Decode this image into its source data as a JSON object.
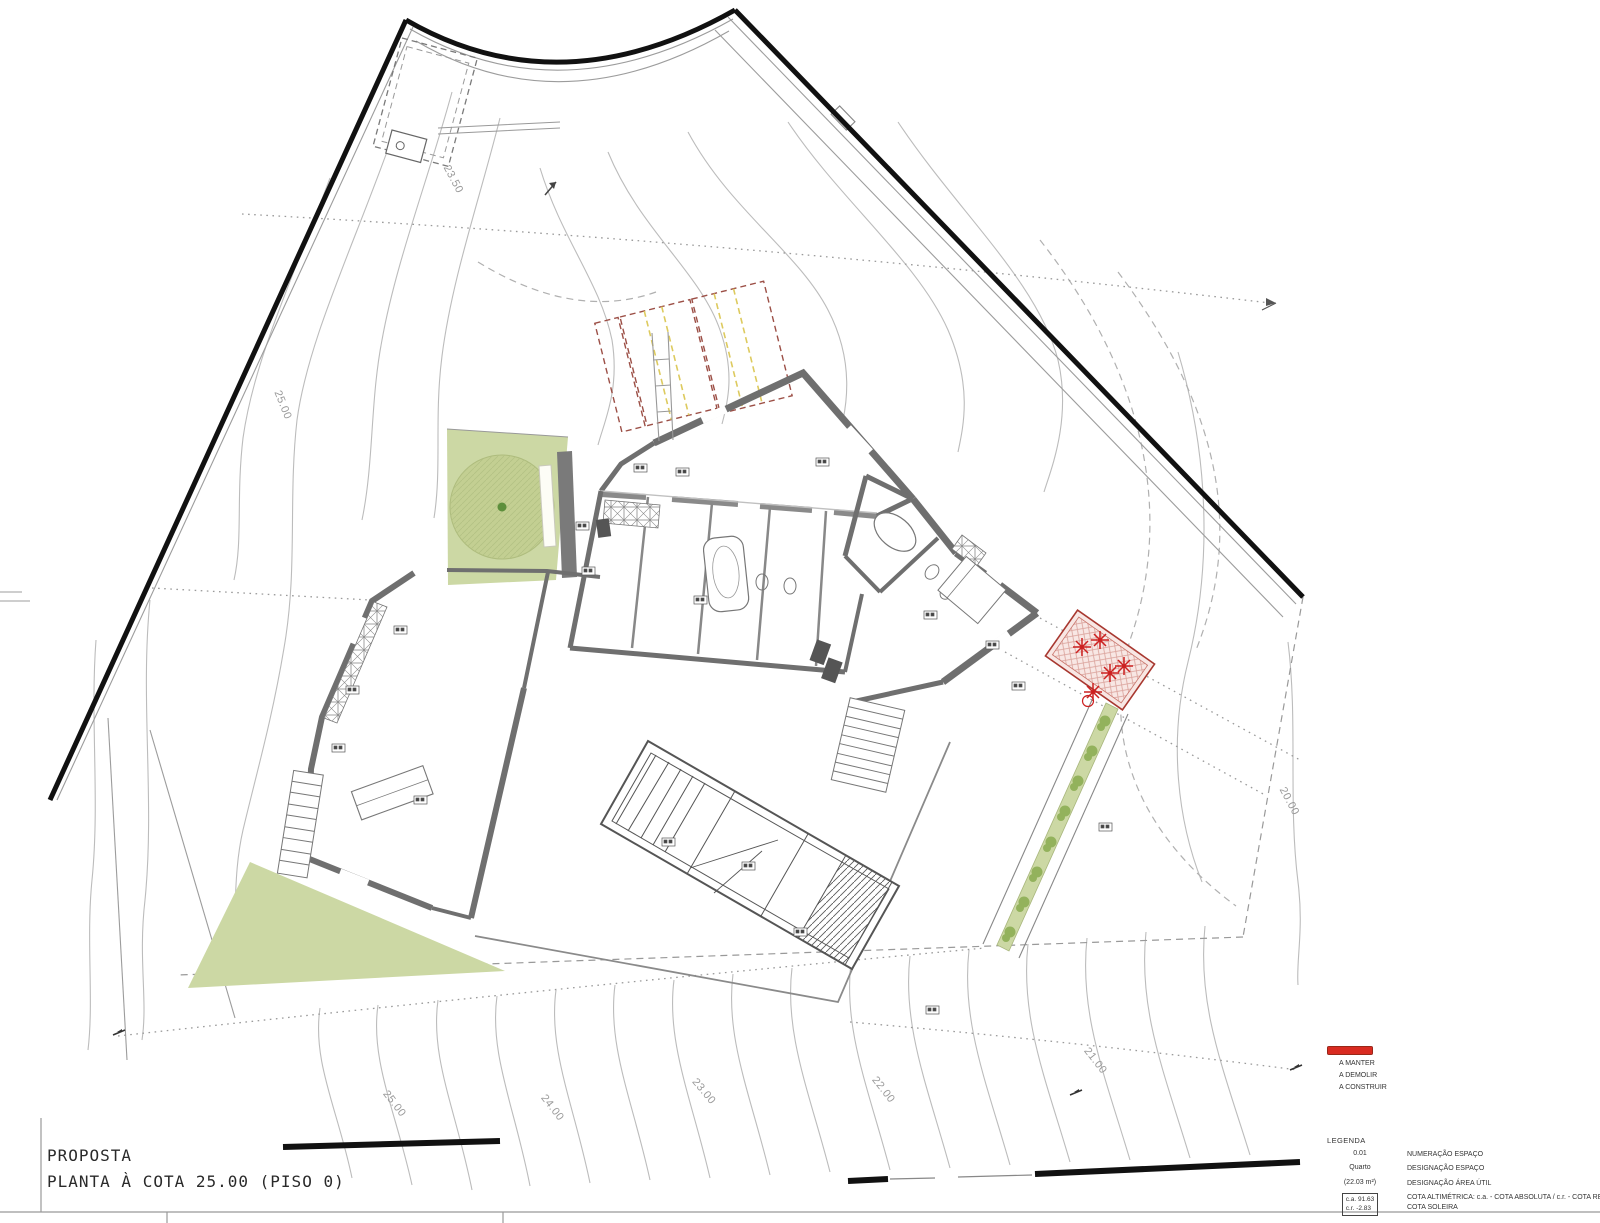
{
  "sheet": {
    "title_line1": "PROPOSTA",
    "title_line2": "PLANTA À COTA 25.00 (PISO 0)"
  },
  "legend_colors": {
    "heading": "LEGENDA",
    "items": [
      {
        "label": "A MANTER",
        "color": "#808080"
      },
      {
        "label": "A DEMOLIR",
        "color": "#f2c335"
      },
      {
        "label": "A CONSTRUIR",
        "color": "#d92b21"
      }
    ]
  },
  "legend_symbols": {
    "heading": "LEGENDA",
    "rows": [
      {
        "symbol": "0.01",
        "description": "NUMERAÇÃO ESPAÇO"
      },
      {
        "symbol": "Quarto",
        "description": "DESIGNAÇÃO ESPAÇO"
      },
      {
        "symbol": "(22.03 m²)",
        "description": "DESIGNAÇÃO ÁREA ÚTIL"
      }
    ],
    "cota_row": {
      "box_line1": "c.a. 91.63",
      "box_line2": "c.r. -2.83",
      "description": "COTA ALTIMÉTRICA: c.a. - COTA ABSOLUTA / c.r. - COTA RELATIVA / c.s. - COTA SOLEIRA"
    }
  },
  "contour_labels": [
    {
      "value": "23.50"
    },
    {
      "value": "25.00"
    },
    {
      "value": "25.00"
    },
    {
      "value": "24.00"
    },
    {
      "value": "23.00"
    },
    {
      "value": "22.00"
    },
    {
      "value": "21.00"
    },
    {
      "value": "20.00"
    }
  ],
  "colors": {
    "green_area": "#ccd8a4",
    "tree_canopy": "#c3cf92",
    "wall_gray": "#6f6f6f",
    "boundary_black": "#111111",
    "contour_gray": "#bcbcbc",
    "construct_red": "#cc2020",
    "demolish_outline": "#9c4f46",
    "demolish_yellow": "#ddca5e"
  }
}
